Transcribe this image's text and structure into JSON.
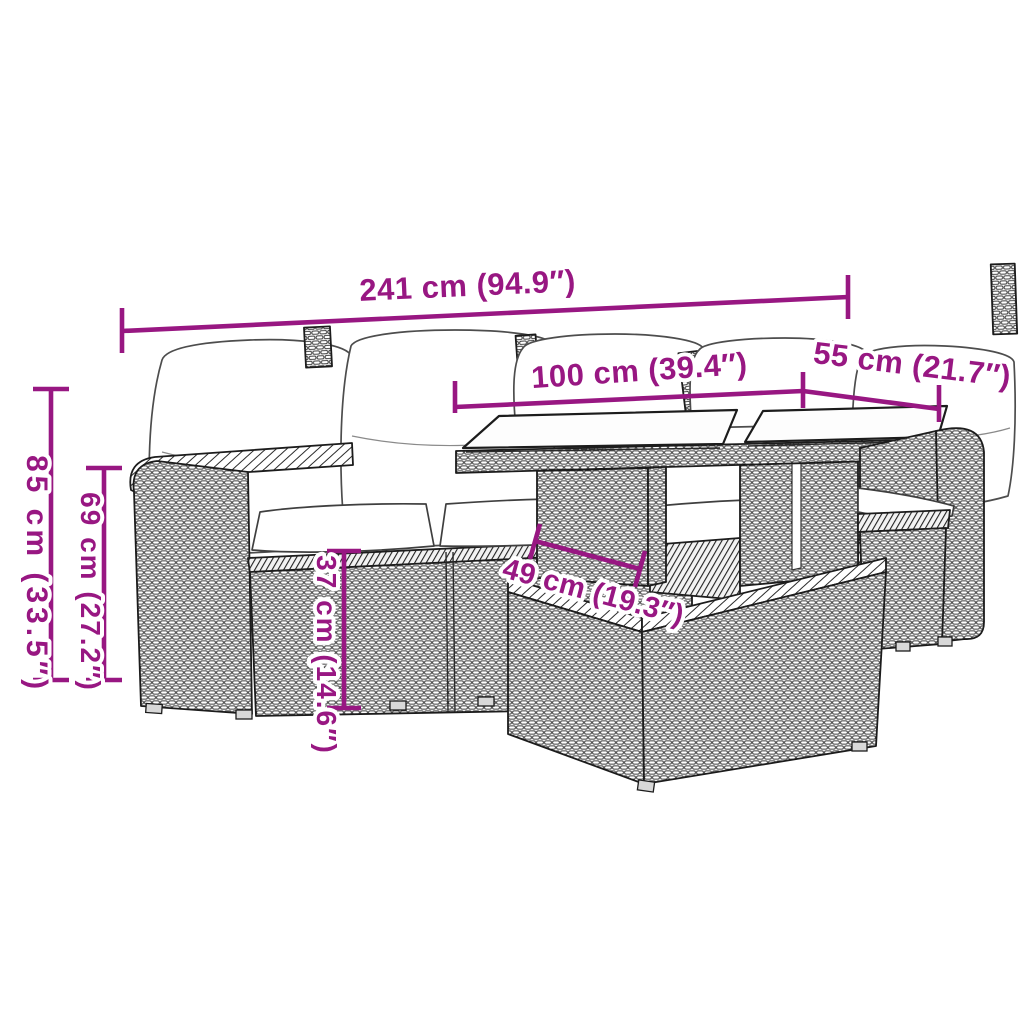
{
  "style": {
    "accent_color": "#981782",
    "outline_color": "#1c1c1c",
    "weave_line_color": "#3f3f3f",
    "cushion_color": "#ffffff",
    "background_color": "#ffffff"
  },
  "figure": {
    "type": "furniture-dimension-diagram",
    "subject": "rattan garden lounge set: corner sofa with cushions, glass-top table, armchair and ottoman"
  },
  "dimensions": [
    {
      "id": "overall-width",
      "label": "241 cm (94.9″)"
    },
    {
      "id": "table-length",
      "label": "100 cm (39.4″)"
    },
    {
      "id": "table-depth",
      "label": "55 cm (21.7″)"
    },
    {
      "id": "overall-height",
      "label": "85 cm (33.5″)"
    },
    {
      "id": "backrest-height",
      "label": "69 cm (27.2″)"
    },
    {
      "id": "seat-height",
      "label": "37 cm (14.6″)"
    },
    {
      "id": "ottoman-width",
      "label": "49 cm (19.3″)"
    }
  ]
}
